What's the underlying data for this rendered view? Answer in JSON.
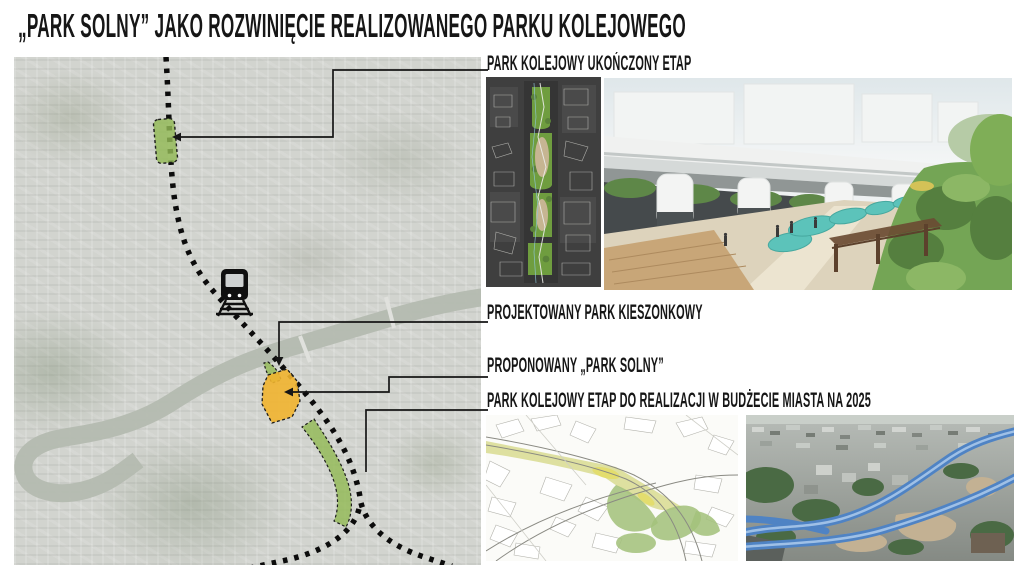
{
  "title": "„PARK SOLNY” JAKO ROZWINIĘCIE REALIZOWANEGO PARKU KOLEJOWEGO",
  "callouts": {
    "completed": "PARK KOLEJOWY UKOŃCZONY ETAP",
    "pocket_park": "PROJEKTOWANY PARK KIESZONKOWY",
    "park_solny": "PROPONOWANY „PARK SOLNY”",
    "stage_2025": "PARK KOLEJOWY ETAP DO REALIZACJI W BUDŻECIE MIASTA NA 2025"
  },
  "map": {
    "icons": [
      "train-icon",
      "railway-dotted-line"
    ],
    "areas": [
      {
        "name": "completed-park-area",
        "color": "#92ba55"
      },
      {
        "name": "pocket-park-area",
        "color": "#92ba55"
      },
      {
        "name": "park-solny-area",
        "color": "#f1b42f"
      },
      {
        "name": "stage-2025-area",
        "color": "#92ba55"
      }
    ]
  },
  "colors": {
    "accent_green": "#92ba55",
    "accent_orange": "#f1b42f",
    "line_black": "#141414",
    "background": "#ffffff"
  }
}
